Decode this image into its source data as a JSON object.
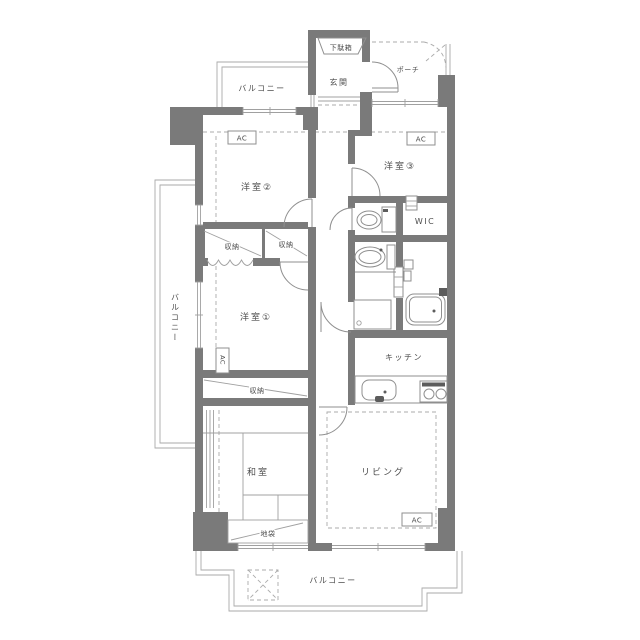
{
  "floorplan": {
    "labels": {
      "balcony_top": "バルコニー",
      "balcony_left": "バルコニー",
      "balcony_bottom": "バルコニー",
      "shoe_cabinet": "下駄箱",
      "entrance": "玄関",
      "porch": "ポーチ",
      "western_room_1": "洋室①",
      "western_room_2": "洋室②",
      "western_room_3": "洋室③",
      "storage_1": "収納",
      "storage_2": "収納",
      "storage_3": "収納",
      "wic": "WIC",
      "kitchen": "キッチン",
      "living": "リビング",
      "japanese_room": "和室",
      "floor_cabinet": "地袋",
      "ac": "AC"
    },
    "colors": {
      "wall": "#7a7a7a",
      "line": "#8f8f8f",
      "dash": "#ababab",
      "text": "#4d4d4d",
      "background": "#ffffff"
    }
  }
}
